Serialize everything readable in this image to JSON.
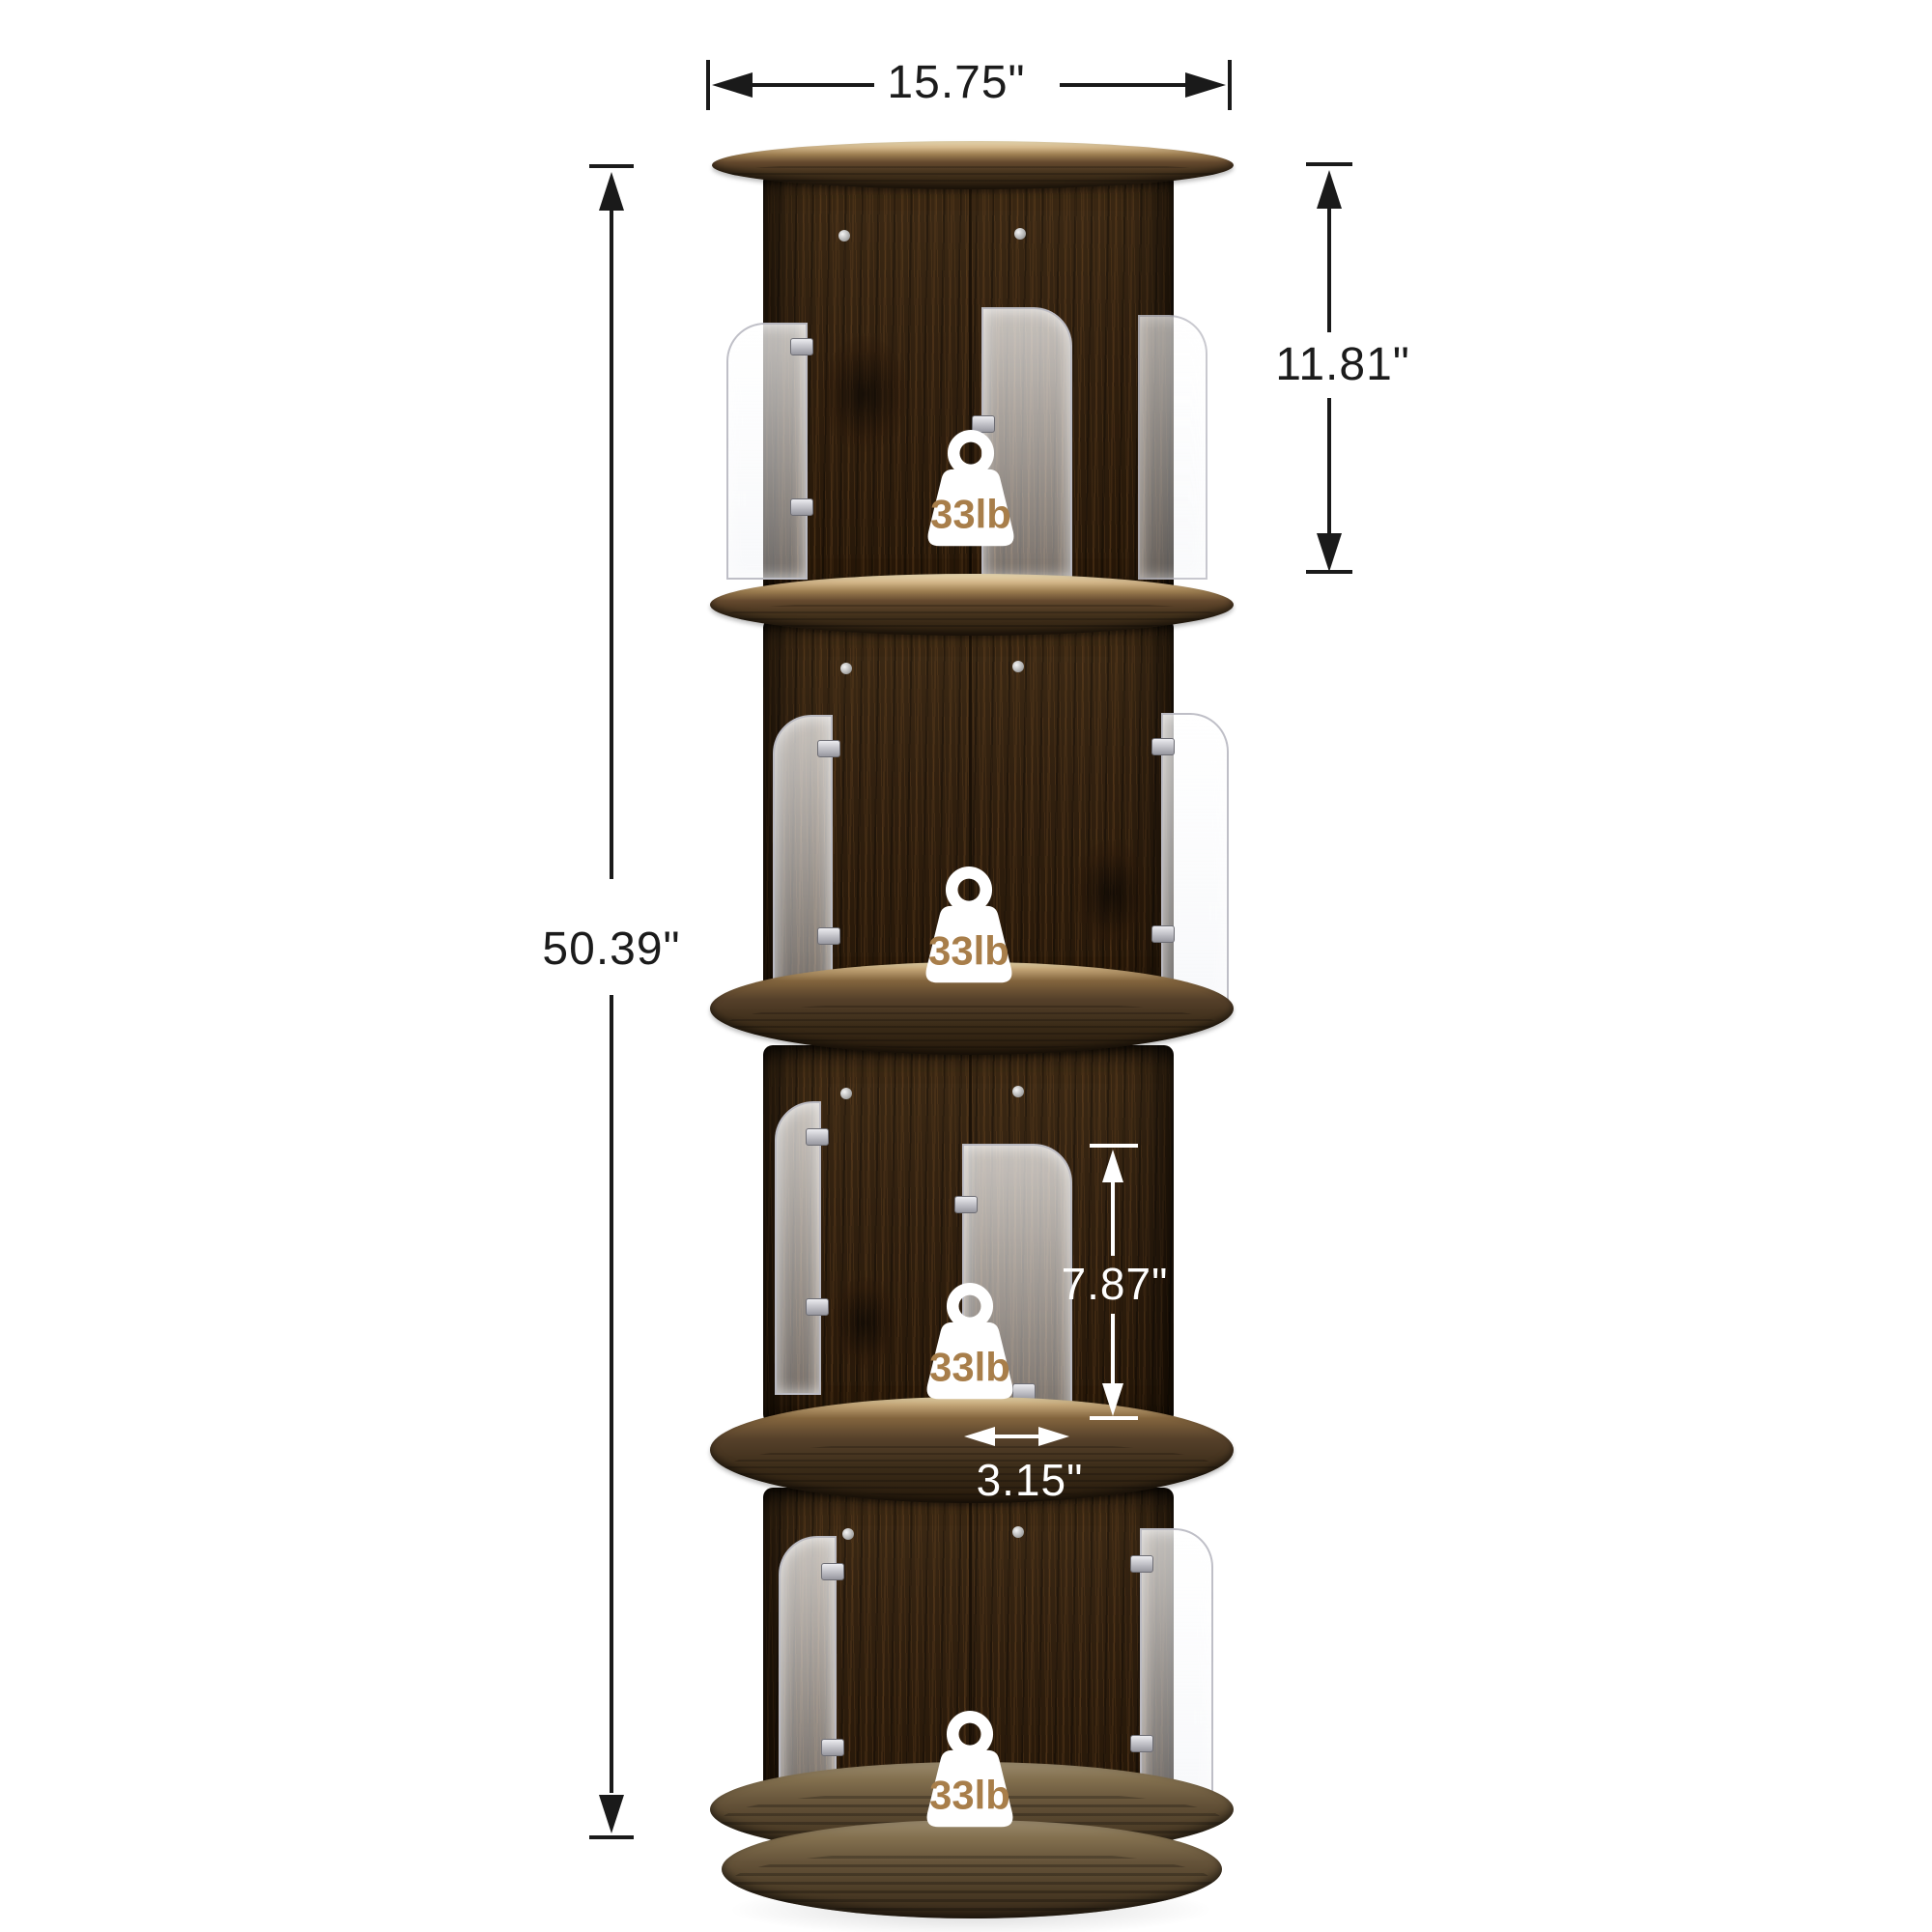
{
  "dimensions": {
    "width_top": "15.75\"",
    "tier_height": "11.81\"",
    "total_height": "50.39\"",
    "shelf_clearance": "7.87\"",
    "divider_gap": "3.15\""
  },
  "badges": [
    {
      "label": "33lb"
    },
    {
      "label": "33lb"
    },
    {
      "label": "33lb"
    },
    {
      "label": "33lb"
    }
  ],
  "colors": {
    "background": "#ffffff",
    "dimension_black": "#1a1a1a",
    "dimension_white": "#ffffff",
    "badge_fill": "#ffffff",
    "badge_text": "#a87e4a",
    "wood_dark": "#31200f",
    "shelf_tan": "#d2b588",
    "base_wood": "#83704f"
  }
}
